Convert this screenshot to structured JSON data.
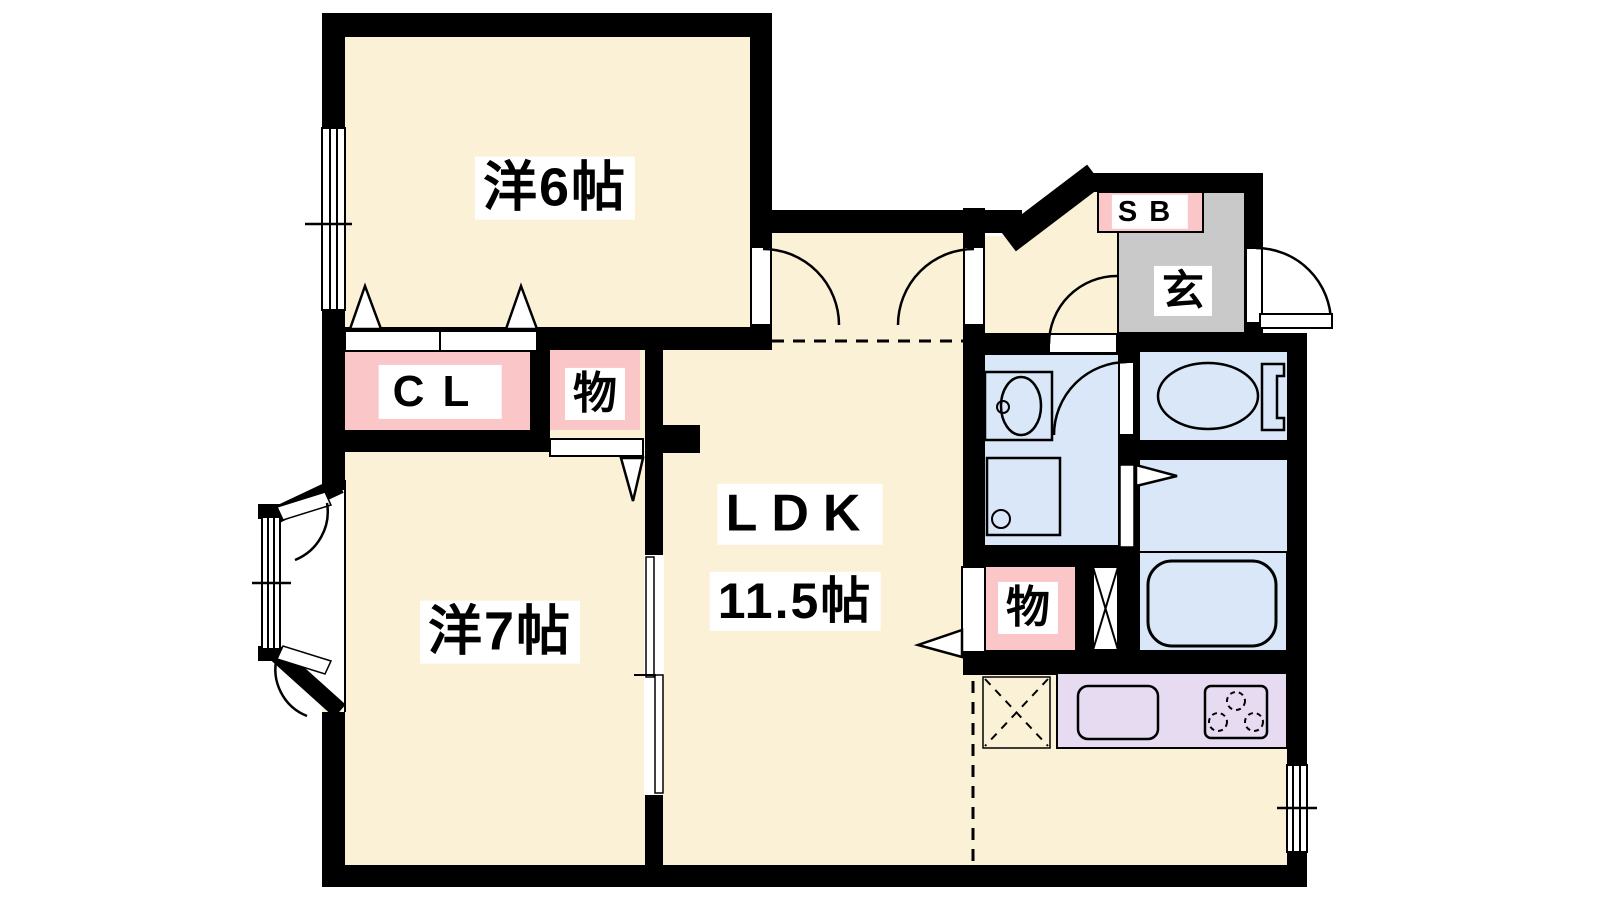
{
  "colors": {
    "floor": "#FBF1D6",
    "closet": "#FAC6C8",
    "sanitary": "#D9E7F8",
    "kitchen": "#E7DBF2",
    "genkan": "#C9C9C9",
    "wall": "#000000"
  },
  "rooms": {
    "bedroom6": {
      "label": "洋6帖"
    },
    "bedroom7": {
      "label": "洋7帖"
    },
    "ldk": {
      "label": "LDK",
      "size": "11.5帖"
    },
    "closet": {
      "label": "CL"
    },
    "storage_top": {
      "label": "物"
    },
    "storage_bottom": {
      "label": "物"
    },
    "entrance": {
      "label": "玄"
    },
    "shoe_box": {
      "label": "SB"
    }
  }
}
